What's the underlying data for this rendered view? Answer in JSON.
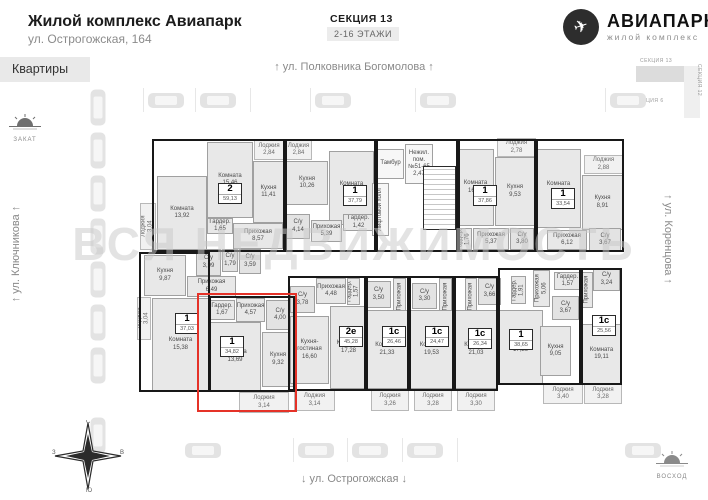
{
  "header": {
    "title": "Жилой комплекс Авиапарк",
    "address": "ул. Острогожская, 164",
    "section_label": "СЕКЦИЯ 13",
    "floors_badge": "2-16 ЭТАЖИ",
    "brand_name": "АВИАПАРК",
    "brand_tagline": "жилой комплекс"
  },
  "tabs": {
    "apartments_label": "Квартиры"
  },
  "streets": {
    "top": "↑ ул. Полковника Богомолова ↑",
    "left": "↑ ул. Ключникова ↑",
    "right": "↑ ул. Коренцова ↑",
    "bottom": "↓ ул. Острогожская ↓"
  },
  "sun_markers": {
    "sunset": "ЗАКАТ",
    "sunrise": "ВОСХОД"
  },
  "watermark": "ВСЯ НЕДВИЖИМОСТЬ",
  "inset": {
    "section_top": "СЕКЦИЯ 13",
    "position": "ПОЗИЦИЯ 6",
    "section_right": "СЕКЦИЯ 12"
  },
  "compass": {
    "n": "С",
    "e": "В",
    "s": "Ю",
    "w": "З"
  },
  "colors": {
    "highlight_red": "#e53228",
    "wall": "#181818",
    "room_fill": "#e8e8e8"
  },
  "plan": {
    "rooms": [
      {
        "n": "Лоджия",
        "a": "3,04",
        "x": 140,
        "y": 203,
        "w": 16,
        "h": 47,
        "v": 1,
        "c": "loggia"
      },
      {
        "n": "Комната",
        "a": "13,92",
        "x": 157,
        "y": 176,
        "w": 50,
        "h": 74
      },
      {
        "n": "Комната",
        "a": "15,46",
        "x": 207,
        "y": 142,
        "w": 46,
        "h": 76
      },
      {
        "n": "Кухня",
        "a": "11,41",
        "x": 253,
        "y": 161,
        "w": 31,
        "h": 62
      },
      {
        "n": "Лоджия",
        "a": "2,84",
        "x": 254,
        "y": 140,
        "w": 30,
        "h": 20,
        "c": "loggia"
      },
      {
        "n": "Гардер.",
        "a": "1,65",
        "x": 207,
        "y": 218,
        "w": 26,
        "h": 16
      },
      {
        "n": "Прихожая",
        "a": "8,57",
        "x": 233,
        "y": 223,
        "w": 50,
        "h": 26
      },
      {
        "n": "С/у",
        "a": "3,99",
        "x": 196,
        "y": 249,
        "w": 25,
        "h": 27,
        "c": "wet"
      },
      {
        "n": "С/у",
        "a": "1,79",
        "x": 222,
        "y": 249,
        "w": 16,
        "h": 23,
        "c": "wet"
      },
      {
        "n": "С/у",
        "a": "3,59",
        "x": 239,
        "y": 249,
        "w": 22,
        "h": 25,
        "c": "wet"
      },
      {
        "n": "Лоджия",
        "a": "2,84",
        "x": 285,
        "y": 140,
        "w": 27,
        "h": 20,
        "c": "loggia"
      },
      {
        "n": "Кухня",
        "a": "10,26",
        "x": 286,
        "y": 161,
        "w": 42,
        "h": 44
      },
      {
        "n": "Комната",
        "a": "15,14",
        "x": 329,
        "y": 151,
        "w": 45,
        "h": 74
      },
      {
        "n": "Гардер.",
        "a": "1,42",
        "x": 343,
        "y": 214,
        "w": 31,
        "h": 17
      },
      {
        "n": "Прихожая",
        "a": "5,39",
        "x": 311,
        "y": 220,
        "w": 31,
        "h": 22
      },
      {
        "n": "С/у",
        "a": "4,14",
        "x": 286,
        "y": 214,
        "w": 24,
        "h": 25,
        "c": "wet"
      },
      {
        "n": "Тамбур",
        "a": "",
        "x": 377,
        "y": 149,
        "w": 27,
        "h": 30,
        "c": "core"
      },
      {
        "n": "Нежил. пом. №51-65",
        "a": "2,47",
        "x": 405,
        "y": 144,
        "w": 28,
        "h": 40,
        "c": "core"
      },
      {
        "n": "Лифтовой холл",
        "a": "",
        "x": 372,
        "y": 183,
        "w": 17,
        "h": 53,
        "v": 1,
        "c": "core"
      },
      {
        "n": "",
        "a": "",
        "x": 423,
        "y": 166,
        "w": 33,
        "h": 64,
        "c": "stairs"
      },
      {
        "n": "Комната",
        "a": "16,01",
        "x": 457,
        "y": 149,
        "w": 37,
        "h": 77
      },
      {
        "n": "Кухня",
        "a": "9,53",
        "x": 495,
        "y": 157,
        "w": 40,
        "h": 69
      },
      {
        "n": "Лоджия",
        "a": "2,78",
        "x": 497,
        "y": 138,
        "w": 39,
        "h": 19,
        "c": "loggia"
      },
      {
        "n": "Гардер.",
        "a": "1,76",
        "x": 457,
        "y": 228,
        "w": 15,
        "h": 22,
        "v": 1
      },
      {
        "n": "Прихожая",
        "a": "5,37",
        "x": 473,
        "y": 228,
        "w": 36,
        "h": 22
      },
      {
        "n": "С/у",
        "a": "3,80",
        "x": 510,
        "y": 228,
        "w": 24,
        "h": 22,
        "c": "wet"
      },
      {
        "n": "Комната",
        "a": "13,40",
        "x": 536,
        "y": 149,
        "w": 45,
        "h": 79
      },
      {
        "n": "Лоджия",
        "a": "2,88",
        "x": 584,
        "y": 155,
        "w": 39,
        "h": 19,
        "c": "loggia"
      },
      {
        "n": "Кухня",
        "a": "8,91",
        "x": 582,
        "y": 175,
        "w": 41,
        "h": 55
      },
      {
        "n": "Прихожая",
        "a": "6,12",
        "x": 547,
        "y": 230,
        "w": 40,
        "h": 20
      },
      {
        "n": "С/у",
        "a": "3,67",
        "x": 589,
        "y": 228,
        "w": 32,
        "h": 24,
        "c": "wet"
      },
      {
        "n": "Кухня",
        "a": "9,87",
        "x": 144,
        "y": 255,
        "w": 42,
        "h": 41
      },
      {
        "n": "Прихожая",
        "a": "6,49",
        "x": 187,
        "y": 276,
        "w": 49,
        "h": 21
      },
      {
        "n": "Лоджия",
        "a": "3,04",
        "x": 137,
        "y": 297,
        "w": 14,
        "h": 43,
        "v": 1,
        "c": "loggia"
      },
      {
        "n": "Комната",
        "a": "15,38",
        "x": 152,
        "y": 298,
        "w": 57,
        "h": 93
      },
      {
        "n": "Гардер.",
        "a": "1,67",
        "x": 209,
        "y": 300,
        "w": 26,
        "h": 20
      },
      {
        "n": "Прихожая",
        "a": "4,57",
        "x": 236,
        "y": 298,
        "w": 29,
        "h": 24
      },
      {
        "n": "С/у",
        "a": "4,00",
        "x": 266,
        "y": 300,
        "w": 28,
        "h": 30,
        "c": "wet"
      },
      {
        "n": "Комната",
        "a": "13,69",
        "x": 209,
        "y": 322,
        "w": 52,
        "h": 69
      },
      {
        "n": "Кухня",
        "a": "9,32",
        "x": 262,
        "y": 332,
        "w": 32,
        "h": 55
      },
      {
        "n": "Лоджия",
        "a": "3,14",
        "x": 239,
        "y": 392,
        "w": 50,
        "h": 21,
        "c": "loggia"
      },
      {
        "n": "С/у",
        "a": "3,78",
        "x": 290,
        "y": 286,
        "w": 25,
        "h": 27,
        "c": "wet"
      },
      {
        "n": "Прихожая",
        "a": "4,48",
        "x": 316,
        "y": 278,
        "w": 30,
        "h": 26
      },
      {
        "n": "Гардер.",
        "a": "1,57",
        "x": 347,
        "y": 278,
        "w": 13,
        "h": 27,
        "v": 1
      },
      {
        "n": "Кухня-гостиная",
        "a": "16,60",
        "x": 290,
        "y": 316,
        "w": 39,
        "h": 68
      },
      {
        "n": "Комната",
        "a": "17,28",
        "x": 330,
        "y": 306,
        "w": 37,
        "h": 83
      },
      {
        "n": "Лоджия",
        "a": "3,14",
        "x": 294,
        "y": 390,
        "w": 41,
        "h": 21,
        "c": "loggia"
      },
      {
        "n": "С/у",
        "a": "3,50",
        "x": 366,
        "y": 281,
        "w": 25,
        "h": 27,
        "c": "wet"
      },
      {
        "n": "Прихожая",
        "a": "",
        "x": 393,
        "y": 278,
        "w": 13,
        "h": 37,
        "v": 1
      },
      {
        "n": "Комната",
        "a": "21,33",
        "x": 366,
        "y": 310,
        "w": 42,
        "h": 79
      },
      {
        "n": "Лоджия",
        "a": "3,26",
        "x": 371,
        "y": 390,
        "w": 38,
        "h": 21,
        "c": "loggia"
      },
      {
        "n": "С/у",
        "a": "3,30",
        "x": 412,
        "y": 283,
        "w": 25,
        "h": 26,
        "c": "wet"
      },
      {
        "n": "Прихожая",
        "a": "",
        "x": 439,
        "y": 278,
        "w": 13,
        "h": 37,
        "v": 1
      },
      {
        "n": "Комната",
        "a": "19,53",
        "x": 410,
        "y": 310,
        "w": 43,
        "h": 79
      },
      {
        "n": "Лоджия",
        "a": "3,28",
        "x": 414,
        "y": 390,
        "w": 38,
        "h": 21,
        "c": "loggia"
      },
      {
        "n": "С/у",
        "a": "3,66",
        "x": 478,
        "y": 278,
        "w": 23,
        "h": 27,
        "c": "wet"
      },
      {
        "n": "Прихожая",
        "a": "",
        "x": 465,
        "y": 278,
        "w": 12,
        "h": 37,
        "v": 1
      },
      {
        "n": "Комната",
        "a": "21,03",
        "x": 454,
        "y": 310,
        "w": 44,
        "h": 79
      },
      {
        "n": "Лоджия",
        "a": "3,30",
        "x": 457,
        "y": 390,
        "w": 38,
        "h": 21,
        "c": "loggia"
      },
      {
        "n": "Гардер.",
        "a": "1,91",
        "x": 511,
        "y": 276,
        "w": 15,
        "h": 28,
        "v": 1
      },
      {
        "n": "Прихожая",
        "a": "5,06",
        "x": 533,
        "y": 270,
        "w": 17,
        "h": 37,
        "v": 1
      },
      {
        "n": "Гардер.",
        "a": "1,57",
        "x": 554,
        "y": 272,
        "w": 27,
        "h": 18
      },
      {
        "n": "С/у",
        "a": "3,67",
        "x": 552,
        "y": 296,
        "w": 27,
        "h": 24,
        "c": "wet"
      },
      {
        "n": "Комната",
        "a": "17,26",
        "x": 498,
        "y": 310,
        "w": 45,
        "h": 74
      },
      {
        "n": "Кухня",
        "a": "9,05",
        "x": 540,
        "y": 326,
        "w": 31,
        "h": 50
      },
      {
        "n": "Лоджия",
        "a": "3,40",
        "x": 543,
        "y": 384,
        "w": 40,
        "h": 20,
        "c": "loggia"
      },
      {
        "n": "С/у",
        "a": "3,24",
        "x": 593,
        "y": 268,
        "w": 27,
        "h": 23,
        "c": "wet"
      },
      {
        "n": "Прихожая",
        "a": "",
        "x": 581,
        "y": 272,
        "w": 12,
        "h": 36,
        "v": 1
      },
      {
        "n": "Комната",
        "a": "19,11",
        "x": 581,
        "y": 324,
        "w": 41,
        "h": 60
      },
      {
        "n": "Лоджия",
        "a": "3,28",
        "x": 584,
        "y": 384,
        "w": 38,
        "h": 20,
        "c": "loggia"
      }
    ],
    "badges": [
      {
        "t": "2",
        "a": "59,13",
        "x": 218,
        "y": 183
      },
      {
        "t": "1",
        "a": "37,79",
        "x": 343,
        "y": 185
      },
      {
        "t": "1",
        "a": "37,86",
        "x": 473,
        "y": 185
      },
      {
        "t": "1",
        "a": "33,54",
        "x": 551,
        "y": 188
      },
      {
        "t": "1",
        "a": "37,03",
        "x": 175,
        "y": 313
      },
      {
        "t": "1",
        "a": "34,82",
        "x": 220,
        "y": 336
      },
      {
        "t": "2е",
        "a": "45,28",
        "x": 339,
        "y": 326
      },
      {
        "t": "1с",
        "a": "26,46",
        "x": 382,
        "y": 326
      },
      {
        "t": "1с",
        "a": "24,47",
        "x": 425,
        "y": 326
      },
      {
        "t": "1с",
        "a": "26,34",
        "x": 468,
        "y": 328
      },
      {
        "t": "1",
        "a": "38,65",
        "x": 509,
        "y": 329
      },
      {
        "t": "1с",
        "a": "25,56",
        "x": 592,
        "y": 315
      }
    ],
    "outlines": [
      {
        "x": 152,
        "y": 139,
        "w": 133,
        "h": 113
      },
      {
        "x": 285,
        "y": 139,
        "w": 91,
        "h": 113
      },
      {
        "x": 376,
        "y": 139,
        "w": 82,
        "h": 113
      },
      {
        "x": 458,
        "y": 139,
        "w": 78,
        "h": 113
      },
      {
        "x": 536,
        "y": 139,
        "w": 88,
        "h": 113
      },
      {
        "x": 139,
        "y": 252,
        "w": 71,
        "h": 140
      },
      {
        "x": 209,
        "y": 296,
        "w": 86,
        "h": 96
      },
      {
        "x": 288,
        "y": 276,
        "w": 78,
        "h": 115
      },
      {
        "x": 366,
        "y": 276,
        "w": 43,
        "h": 115
      },
      {
        "x": 409,
        "y": 276,
        "w": 45,
        "h": 115
      },
      {
        "x": 454,
        "y": 276,
        "w": 44,
        "h": 115
      },
      {
        "x": 498,
        "y": 268,
        "w": 83,
        "h": 117
      },
      {
        "x": 581,
        "y": 268,
        "w": 41,
        "h": 117
      }
    ],
    "highlight": {
      "x": 197,
      "y": 293,
      "w": 100,
      "h": 119
    }
  }
}
